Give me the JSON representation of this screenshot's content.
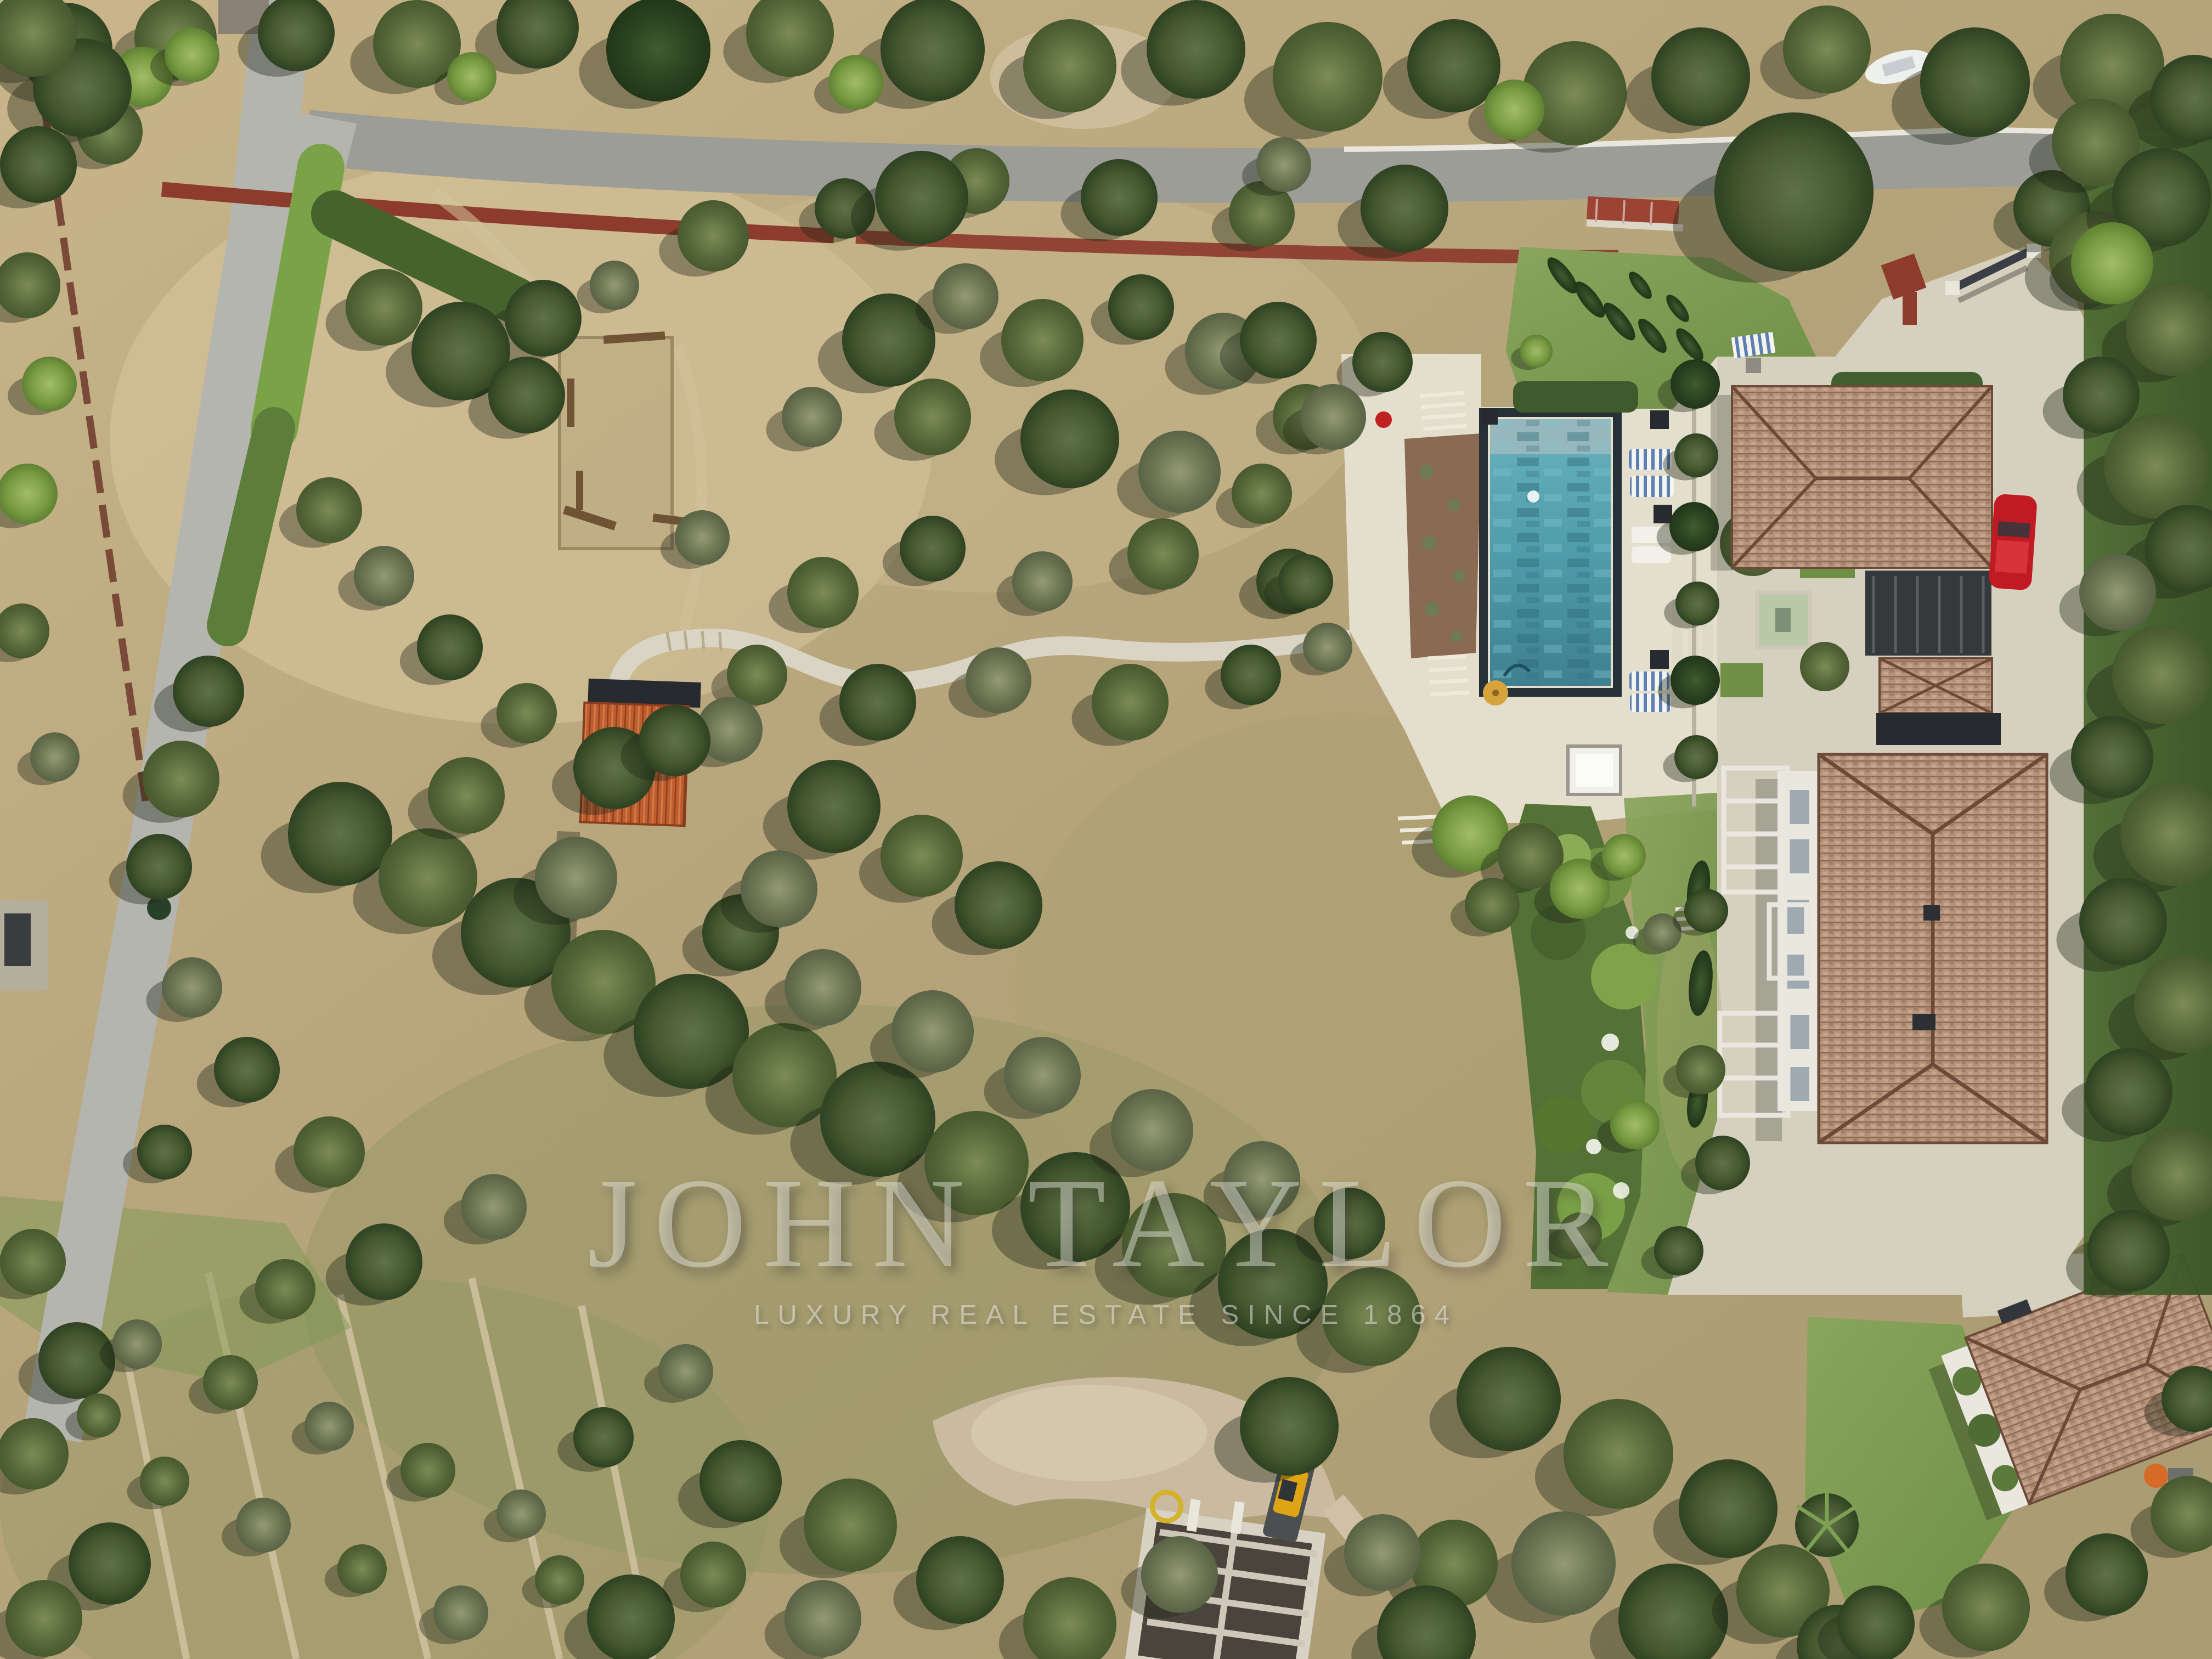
{
  "image": {
    "kind": "aerial-drone-photograph",
    "subject": "Provencal estate: olive grove, rectangular pool, tiled-roof villa, outbuildings, perimeter roads and hedges"
  },
  "watermark": {
    "brand": "JOHN TAYLOR",
    "tagline": "LUXURY REAL ESTATE SINCE 1864"
  },
  "palette": {
    "ground": "#b5a077",
    "groundLight": "#cab689",
    "groundPale": "#d8c79e",
    "road": "#9c9d97",
    "roadLight": "#b5b5af",
    "curb": "#e9e7dd",
    "redWall": "#8d3b2c",
    "paving": "#d6d0bf",
    "pavingBright": "#e4decc",
    "lawn": "#83a055",
    "lawnDeep": "#5f8040",
    "hedge": "#47632f",
    "hedgeBright": "#7aa348",
    "treeDark": "#3c512c",
    "treeMid": "#5d7340",
    "treeGray": "#79855e",
    "cypress": "#304823",
    "poolWater": "#55a4b2",
    "poolDeep": "#3f8495",
    "poolShelf": "#9fbabd",
    "poolRim": "#253136",
    "roofTile": "#b5947c",
    "roofTileDark": "#6d4a37",
    "shedRoof": "#bf5d2e",
    "canopyDark": "#272b30",
    "facade": "#eae7de",
    "carRed": "#c11a22",
    "excavator": "#dfa414",
    "umbrella": "#d7a33c",
    "dirt": "#c9baa0",
    "watermark": "rgba(238,238,232,0.44)",
    "watermarkSub": "rgba(240,240,235,0.5)"
  }
}
